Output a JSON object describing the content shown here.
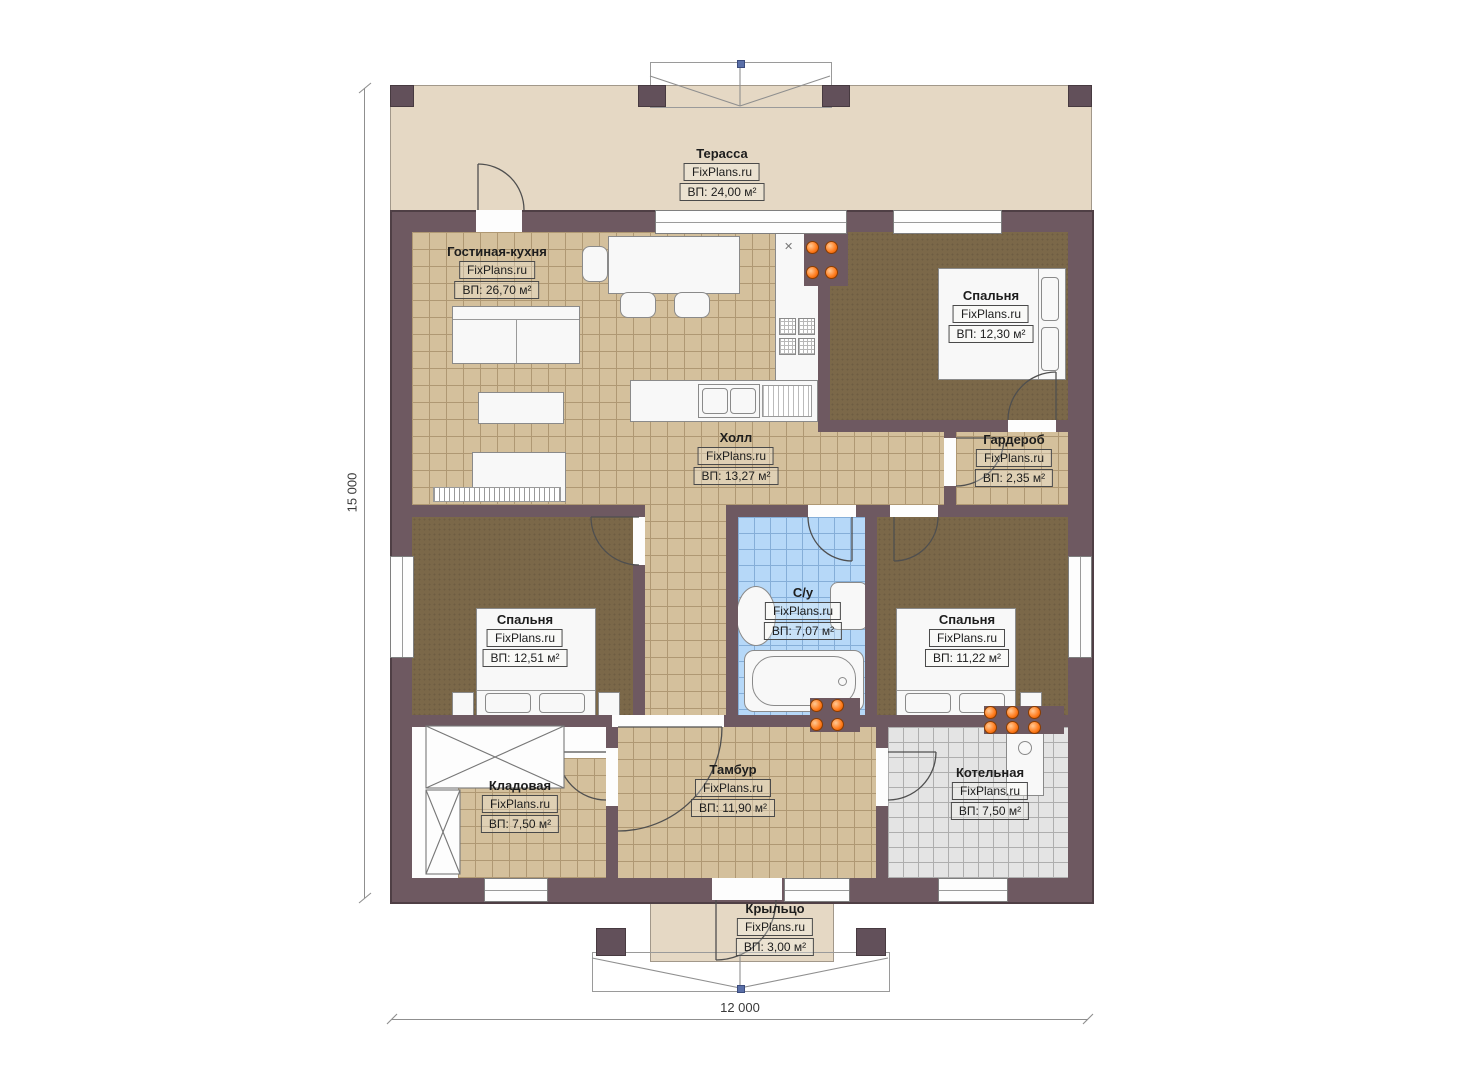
{
  "plan": {
    "brand": "FixPlans.ru",
    "dimensions": {
      "height": "15 000",
      "width": "12 000"
    },
    "rooms": [
      {
        "id": "terrace",
        "name": "Терасса",
        "brand": "FixPlans.ru",
        "area": "ВП: 24,00 м²"
      },
      {
        "id": "living-kitchen",
        "name": "Гостиная-кухня",
        "brand": "FixPlans.ru",
        "area": "ВП: 26,70 м²"
      },
      {
        "id": "bedroom-1",
        "name": "Спальня",
        "brand": "FixPlans.ru",
        "area": "ВП: 12,30 м²"
      },
      {
        "id": "hall",
        "name": "Холл",
        "brand": "FixPlans.ru",
        "area": "ВП: 13,27 м²"
      },
      {
        "id": "wardrobe",
        "name": "Гардероб",
        "brand": "FixPlans.ru",
        "area": "ВП: 2,35 м²"
      },
      {
        "id": "bedroom-2",
        "name": "Спальня",
        "brand": "FixPlans.ru",
        "area": "ВП: 12,51 м²"
      },
      {
        "id": "bathroom",
        "name": "С/у",
        "brand": "FixPlans.ru",
        "area": "ВП: 7,07 м²"
      },
      {
        "id": "bedroom-3",
        "name": "Спальня",
        "brand": "FixPlans.ru",
        "area": "ВП: 11,22 м²"
      },
      {
        "id": "storage",
        "name": "Кладовая",
        "brand": "FixPlans.ru",
        "area": "ВП: 7,50 м²"
      },
      {
        "id": "vestibule",
        "name": "Тамбур",
        "brand": "FixPlans.ru",
        "area": "ВП: 11,90 м²"
      },
      {
        "id": "boiler",
        "name": "Котельная",
        "brand": "FixPlans.ru",
        "area": "ВП: 7,50 м²"
      },
      {
        "id": "porch",
        "name": "Крыльцо",
        "brand": "FixPlans.ru",
        "area": "ВП: 3,00 м²"
      }
    ],
    "colors": {
      "wall": "#6e5961",
      "terrace_floor": "#e5d8c4",
      "tile_floor": "#d4c09c",
      "bedroom_floor": "#7b6849",
      "bath_tile": "#b6d8f8",
      "boiler_tile": "#e4e4e4",
      "radiator_orange": "#ff7a1a",
      "marker_blue": "#5a6fa8"
    },
    "misc": {
      "vent_symbol": "✕"
    }
  }
}
